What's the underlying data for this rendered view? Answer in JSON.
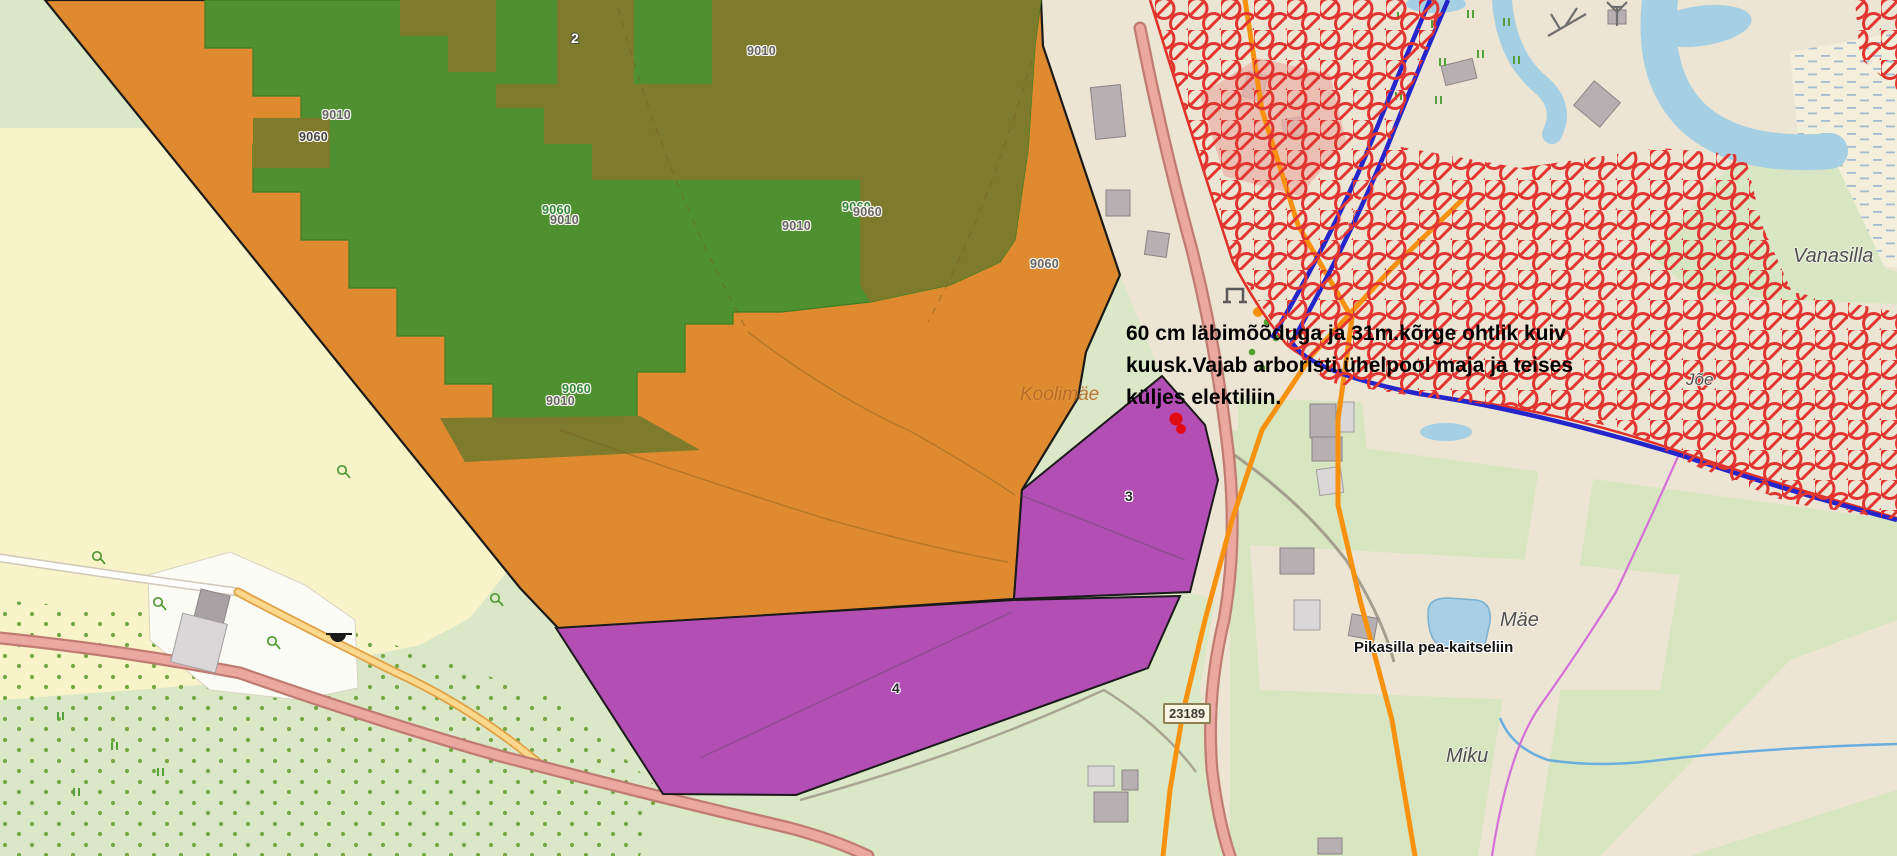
{
  "map": {
    "type": "forestry-web-map",
    "colors": {
      "area_orange": "#df8a2e",
      "stand_green": "#4f9130",
      "stand_olive": "#7e7b2c",
      "parcel_purple": "#b34fb4",
      "restriction_red": "#e23430",
      "boundary_blue": "#2525cc",
      "powerline_orange": "#f8920e",
      "water_blue": "#a5cfe3",
      "road_pink": "#eba8a0",
      "base_green": "#dbe8c8",
      "base_tan": "#ece5d3",
      "base_yellow": "#f8f3c8"
    },
    "annotation": {
      "line1": "60 cm läbimõõduga ja 31m.kõrge ohtlik kuiv",
      "line2": "kuusk.Vajab arboristi.ühelpool maja  ja teises",
      "line3": "küljes elektiliin."
    },
    "stand_labels": [
      {
        "text": "9010"
      },
      {
        "text": "9010"
      },
      {
        "text": "9060"
      },
      {
        "text": "9060"
      },
      {
        "text": "9010"
      },
      {
        "text": "9010"
      },
      {
        "text": "9060"
      },
      {
        "text": "9060"
      },
      {
        "text": "9060"
      },
      {
        "text": "9060"
      },
      {
        "text": "9010"
      }
    ],
    "parcel_labels": [
      {
        "text": "2"
      },
      {
        "text": "3"
      },
      {
        "text": "4"
      }
    ],
    "place_labels": [
      {
        "text": "Vanasilla"
      },
      {
        "text": "Koolimäe"
      },
      {
        "text": "Mäe"
      },
      {
        "text": "Miku"
      },
      {
        "text": "Jõe"
      }
    ],
    "powerline_label": {
      "text": "Pikasilla pea-kaitseliin"
    },
    "road_shield": {
      "number": "23189"
    }
  }
}
